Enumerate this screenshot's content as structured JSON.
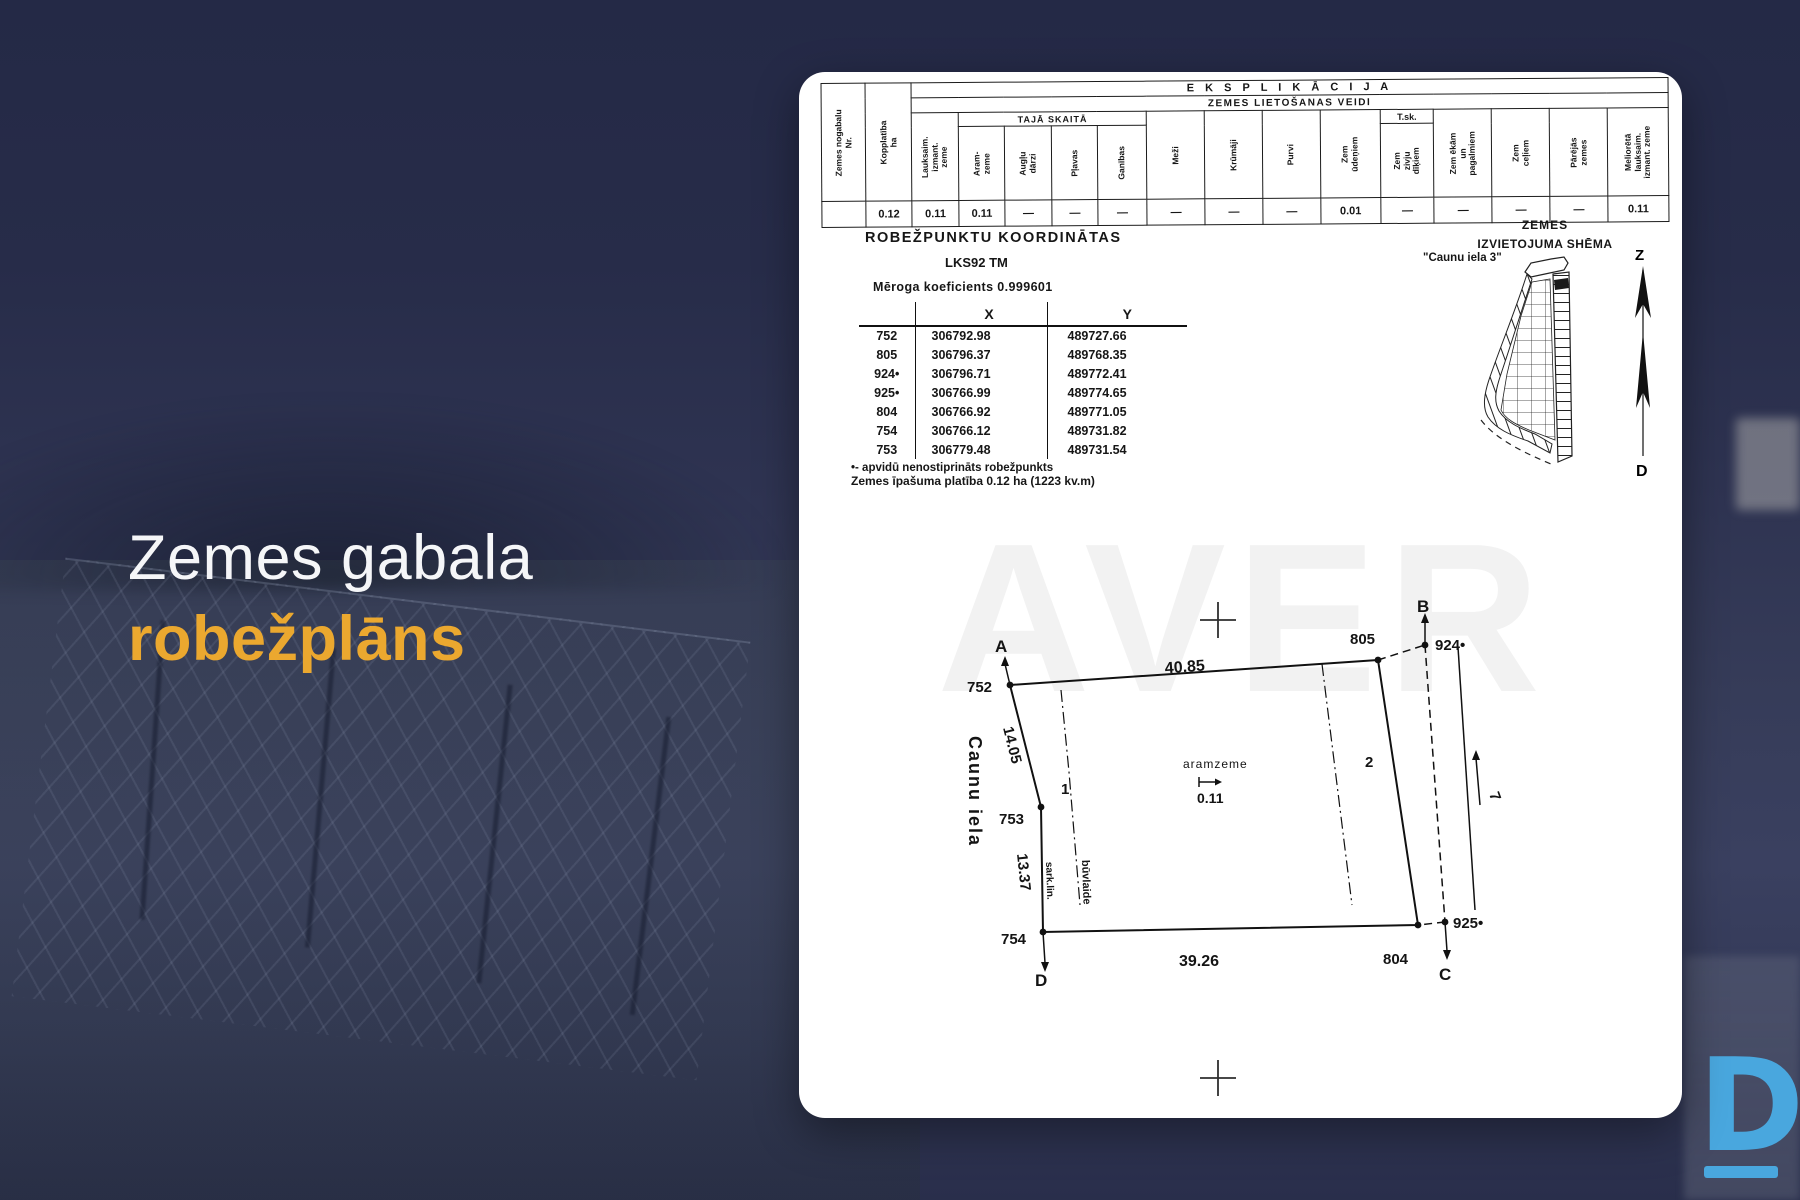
{
  "slide": {
    "title_line1": "Zemes gabala",
    "title_line2": "robežplāns",
    "logo_letter": "D",
    "accent_color": "#EBA82F",
    "logo_color": "#49A7DE",
    "bg_color": "#2B3050"
  },
  "doc": {
    "watermark": "AVER",
    "expl": {
      "title": "E K S P L I K Ā C I J A",
      "subtitle": "ZEMES LIETOŠANAS VEIDI",
      "subsub": "TAJĀ SKAITĀ",
      "tsk": "T.sk.",
      "col_nr": "Zemes nogabalu\nNr.",
      "col_area": "Kopplatība\nha",
      "cols": [
        "Lauksaim.\nizmant.\nzeme",
        "Aram-\nzeme",
        "Augļu\ndārzi",
        "Pļavas",
        "Ganības",
        "Meži",
        "Krūmāji",
        "Purvi",
        "Zem\nūdeņiem",
        "Zem\nzivju\ndīķiem",
        "Zem ēkām\nun\npagalmiem",
        "Zem\nceļiem",
        "Pārējās\nzemes",
        "Meliorētā\nlauksaim.\nizmant. zeme"
      ],
      "values": [
        "",
        "0.12",
        "0.11",
        "0.11",
        "—",
        "—",
        "—",
        "—",
        "—",
        "—",
        "0.01",
        "—",
        "—",
        "—",
        "—",
        "0.11"
      ]
    },
    "coords": {
      "title": "ROBEŽPUNKTU KOORDINĀTAS",
      "datum": "LKS92 TM",
      "scale_note": "Mēroga koeficients 0.999601",
      "col_x": "X",
      "col_y": "Y",
      "points": [
        {
          "id": "752",
          "x": "306792.98",
          "y": "489727.66"
        },
        {
          "id": "805",
          "x": "306796.37",
          "y": "489768.35"
        },
        {
          "id": "924•",
          "x": "306796.71",
          "y": "489772.41"
        },
        {
          "id": "925•",
          "x": "306766.99",
          "y": "489774.65"
        },
        {
          "id": "804",
          "x": "306766.92",
          "y": "489771.05"
        },
        {
          "id": "754",
          "x": "306766.12",
          "y": "489731.82"
        },
        {
          "id": "753",
          "x": "306779.48",
          "y": "489731.54"
        }
      ],
      "footnote": "•- apvidū nenostiprināts robežpunkts",
      "area_note": "Zemes īpašuma platība 0.12 ha (1223 kv.m)"
    },
    "scheme": {
      "title1": "ZEMES",
      "title2": "IZVIETOJUMA SHĒMA",
      "street": "\"Caunu iela 3\"",
      "north": "Z",
      "south": "D"
    },
    "plan": {
      "street": "Caunu iela",
      "pA": "A",
      "pB": "B",
      "pC": "C",
      "pD": "D",
      "p752": "752",
      "p753": "753",
      "p754": "754",
      "p804": "804",
      "p805": "805",
      "p924": "924•",
      "p925": "925•",
      "m_top": "40.85",
      "m_left_upper": "14.05",
      "m_left_lower": "13.37",
      "m_bottom": "39.26",
      "zone1": "1",
      "zone2": "2",
      "landuse": "aramzeme",
      "landuse_area": "0.11",
      "red_line": "sark.lin.",
      "building_line": "būvlaide",
      "arrow7": "7"
    }
  }
}
